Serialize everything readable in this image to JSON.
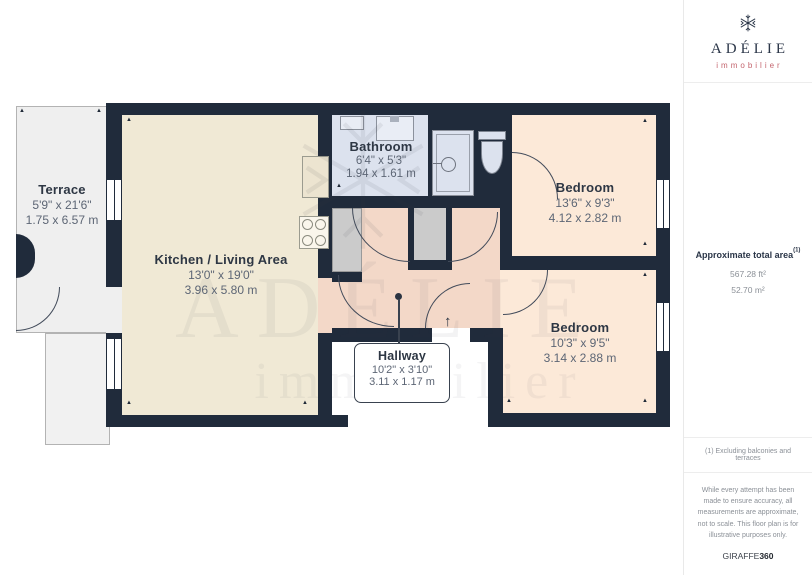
{
  "sidebar": {
    "brand": {
      "name": "ADÉLIE",
      "tagline": "immobilier",
      "brand_color": "#2b3648",
      "tagline_color": "#c4656e"
    },
    "area": {
      "title": "Approximate total area",
      "sup": "(1)",
      "ft": "567.28 ft²",
      "m": "52.70 m²"
    },
    "footnote": "(1) Excluding balconies and terraces",
    "disclaimer": "While every attempt has been made to ensure accuracy, all measurements are approximate, not to scale. This floor plan is for illustrative purposes only.",
    "credit": {
      "brand": "GIRAFFE",
      "suffix": "360"
    }
  },
  "floorplan": {
    "watermark": {
      "line1": "ADÉLIE",
      "line2": "immobilier"
    },
    "rooms": {
      "terrace": {
        "name": "Terrace",
        "imperial": "5'9\" x 21'6\"",
        "metric": "1.75 x 6.57 m"
      },
      "kitchen": {
        "name": "Kitchen / Living Area",
        "imperial": "13'0\" x 19'0\"",
        "metric": "3.96 x 5.80 m"
      },
      "bathroom": {
        "name": "Bathroom",
        "imperial": "6'4\" x 5'3\"",
        "metric": "1.94 x 1.61 m"
      },
      "bedroom1": {
        "name": "Bedroom",
        "imperial": "13'6\" x 9'3\"",
        "metric": "4.12 x 2.82 m"
      },
      "bedroom2": {
        "name": "Bedroom",
        "imperial": "10'3\" x 9'5\"",
        "metric": "3.14 x 2.88 m"
      },
      "hallway": {
        "name": "Hallway",
        "imperial": "10'2\" x 3'10\"",
        "metric": "3.11 x 1.17 m"
      }
    },
    "colors": {
      "wall": "#202b3b",
      "kitchen": "#f0e9d5",
      "bedroom": "#fce9d8",
      "hallway": "#f3d8c8",
      "bathroom": "#dce2ee",
      "closet": "#cbcbcb",
      "terrace": "#efefef"
    },
    "icons": {
      "entrance_arrow": "↑",
      "dimension_marker": "▲",
      "logo": "snowflake-icon"
    }
  }
}
